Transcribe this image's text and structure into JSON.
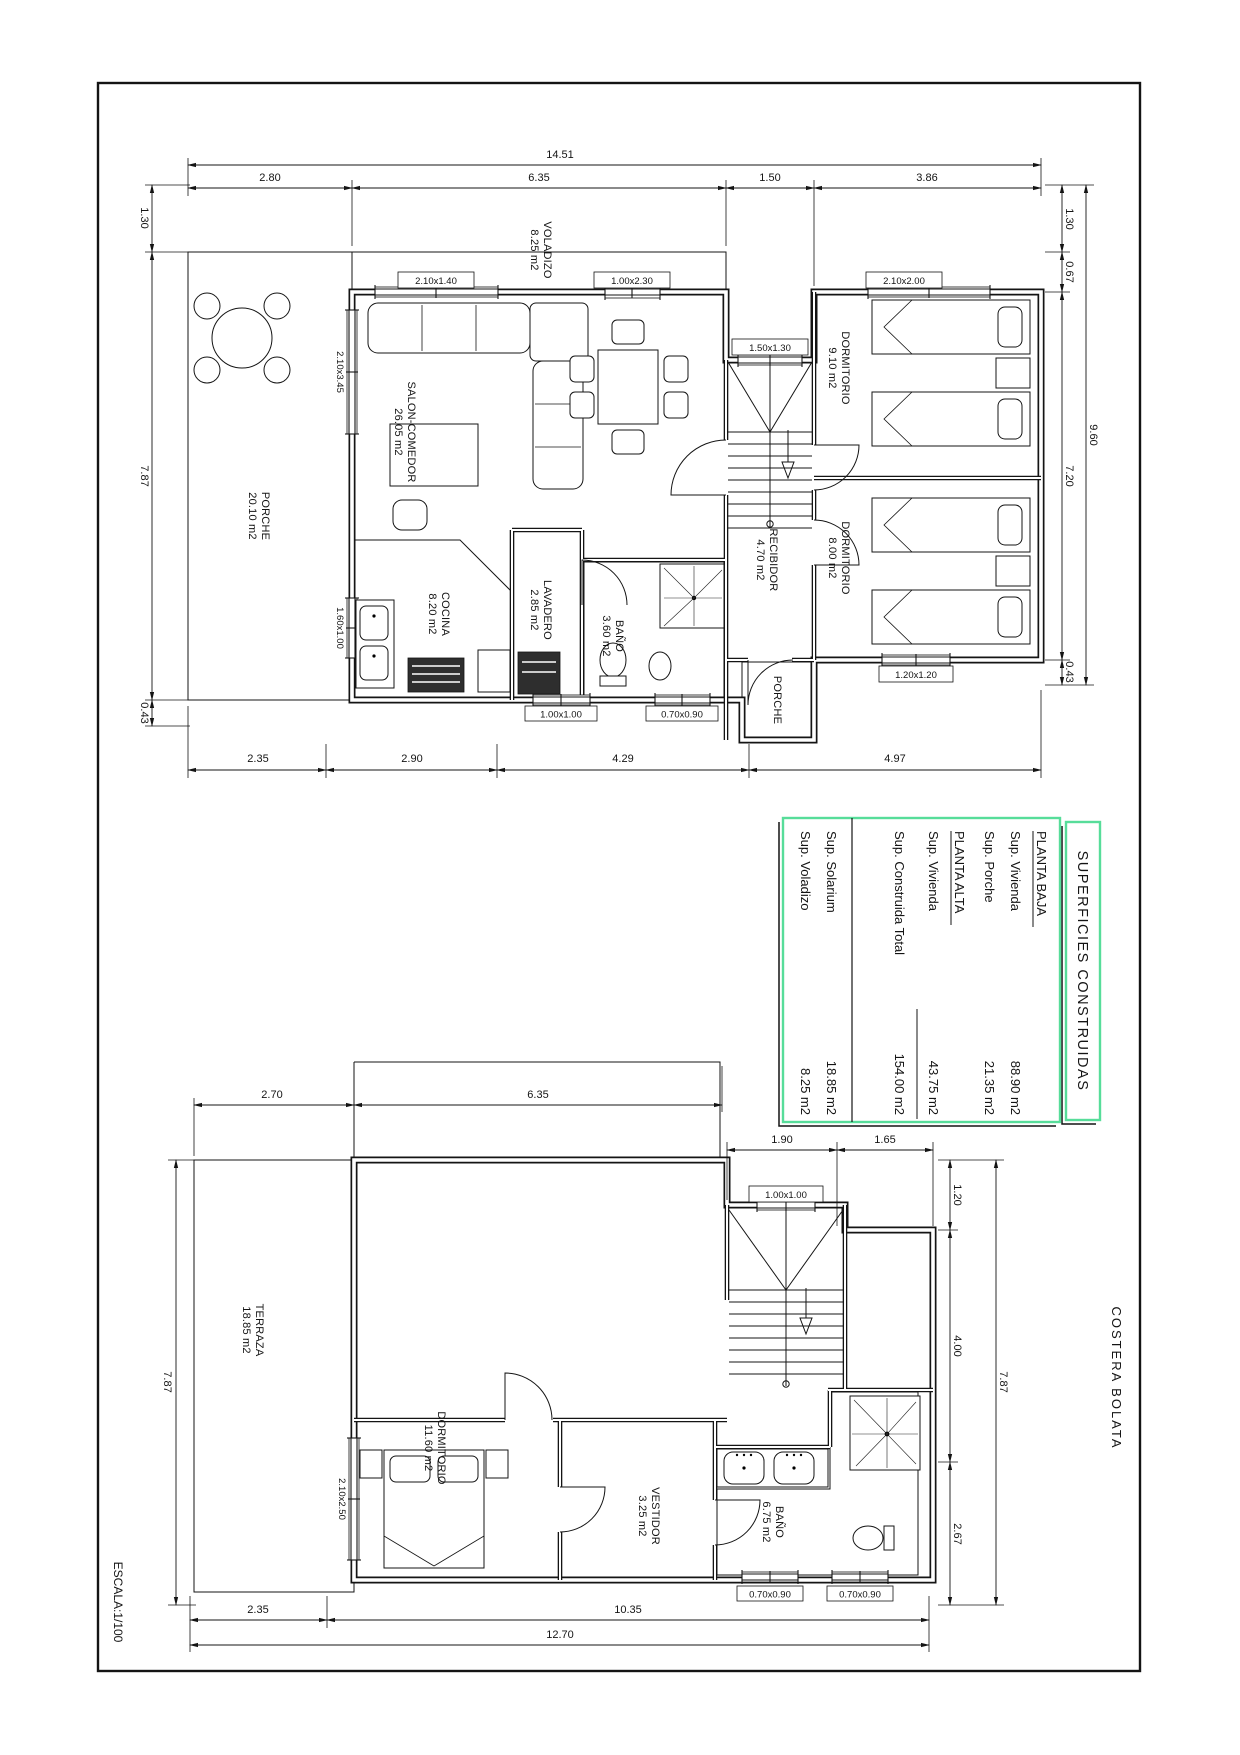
{
  "sheet": {
    "scale_label": "ESCALA:1/100",
    "street_label": "COSTERA BOLATA"
  },
  "summary": {
    "title": "SUPERFICIES CONSTRUIDAS",
    "baja_header": "PLANTA BAJA",
    "baja_rows": [
      {
        "l": "Sup. Vivienda",
        "v": "88.90 m2"
      },
      {
        "l": "Sup. Porche",
        "v": "21.35 m2"
      }
    ],
    "alta_header": "PLANTA ALTA",
    "alta_rows": [
      {
        "l": "Sup. Vivienda",
        "v": "43.75 m2"
      }
    ],
    "total_label": "Sup. Construida Total",
    "total_value": "154.00 m2",
    "extra_rows": [
      {
        "l": "Sup. Solarium",
        "v": "18.85 m2"
      },
      {
        "l": "Sup. Voladizo",
        "v": "8.25 m2"
      }
    ]
  },
  "planta_baja": {
    "rooms": {
      "voladizo": {
        "n": "VOLADIZO",
        "a": "8.25 m2"
      },
      "salon": {
        "n": "SALON-COMEDOR",
        "a": "26.05 m2"
      },
      "porche": {
        "n": "PORCHE",
        "a": "20.10 m2"
      },
      "cocina": {
        "n": "COCINA",
        "a": "8.20 m2"
      },
      "lavadero": {
        "n": "LAVADERO",
        "a": "2.85 m2"
      },
      "bano": {
        "n": "BAÑO",
        "a": "3.60 m2"
      },
      "recibidor": {
        "n": "RECIBIDOR",
        "a": "4.70 m2"
      },
      "dorm1": {
        "n": "DORMITORIO",
        "a": "9.10 m2"
      },
      "dorm2": {
        "n": "DORMITORIO",
        "a": "8.00 m2"
      },
      "porche2": {
        "n": "PORCHE"
      }
    },
    "windows": {
      "w1": "2.10x1.40",
      "d1": "1.00x2.30",
      "w2": "1.50x1.30",
      "w3": "2.10x2.00",
      "w4": "2.10x3.45",
      "w5": "1.60x1.00",
      "w6": "1.00x1.00",
      "w7": "0.70x0.90",
      "w8": "1.20x1.20"
    },
    "dims": {
      "total": "14.51",
      "t1": "2.80",
      "t2": "6.35",
      "t3": "1.50",
      "t4": "3.86",
      "l1": "1.30",
      "l2": "7.87",
      "l3": "0.43",
      "r1": "1.30",
      "r2": "0.67",
      "r3": "7.20",
      "r4": "9.60",
      "r5": "0.43",
      "b1": "2.35",
      "b2": "2.90",
      "b3": "4.29",
      "b4": "4.97"
    }
  },
  "planta_alta": {
    "rooms": {
      "terraza": {
        "n": "TERRAZA",
        "a": "18.85 m2"
      },
      "dorm": {
        "n": "DORMITORIO",
        "a": "11.60 m2"
      },
      "vestidor": {
        "n": "VESTIDOR",
        "a": "3.25 m2"
      },
      "bano": {
        "n": "BAÑO",
        "a": "6.75 m2"
      }
    },
    "windows": {
      "w1": "1.00x1.00",
      "w2": "2.10x2.50",
      "w3": "0.70x0.90",
      "w4": "0.70x0.90"
    },
    "dims": {
      "t1": "2.70",
      "t2": "6.35",
      "u1": "1.90",
      "u2": "1.65",
      "r1": "1.20",
      "r2": "4.00",
      "r3": "2.67",
      "r4": "7.87",
      "l1": "7.87",
      "b1": "2.35",
      "b2": "10.35",
      "b3": "12.70"
    }
  }
}
